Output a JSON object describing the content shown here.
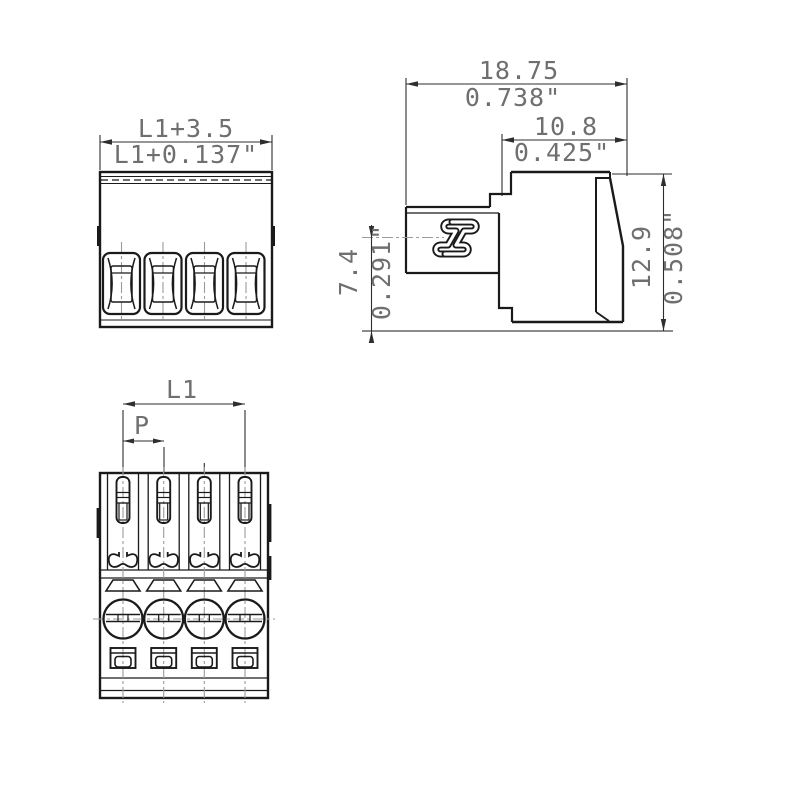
{
  "drawing": {
    "pole_count": 4,
    "dims": {
      "front_width_mm": "L1+3.5",
      "front_width_inch": "L1+0.137\"",
      "side_overall_mm": "18.75",
      "side_overall_inch": "0.738\"",
      "side_housing_mm": "10.8",
      "side_housing_inch": "0.425\"",
      "side_height_mm": "12.9",
      "side_height_inch": "0.508\"",
      "side_wire_axis_mm": "7.4",
      "side_wire_axis_inch": "0.291\"",
      "plan_length": "L1",
      "plan_pitch": "P"
    },
    "colors": {
      "line": "#1a1a1a",
      "dim_text": "#6f6f6f",
      "centerline": "#9b9b9b",
      "background": "#ffffff"
    }
  }
}
